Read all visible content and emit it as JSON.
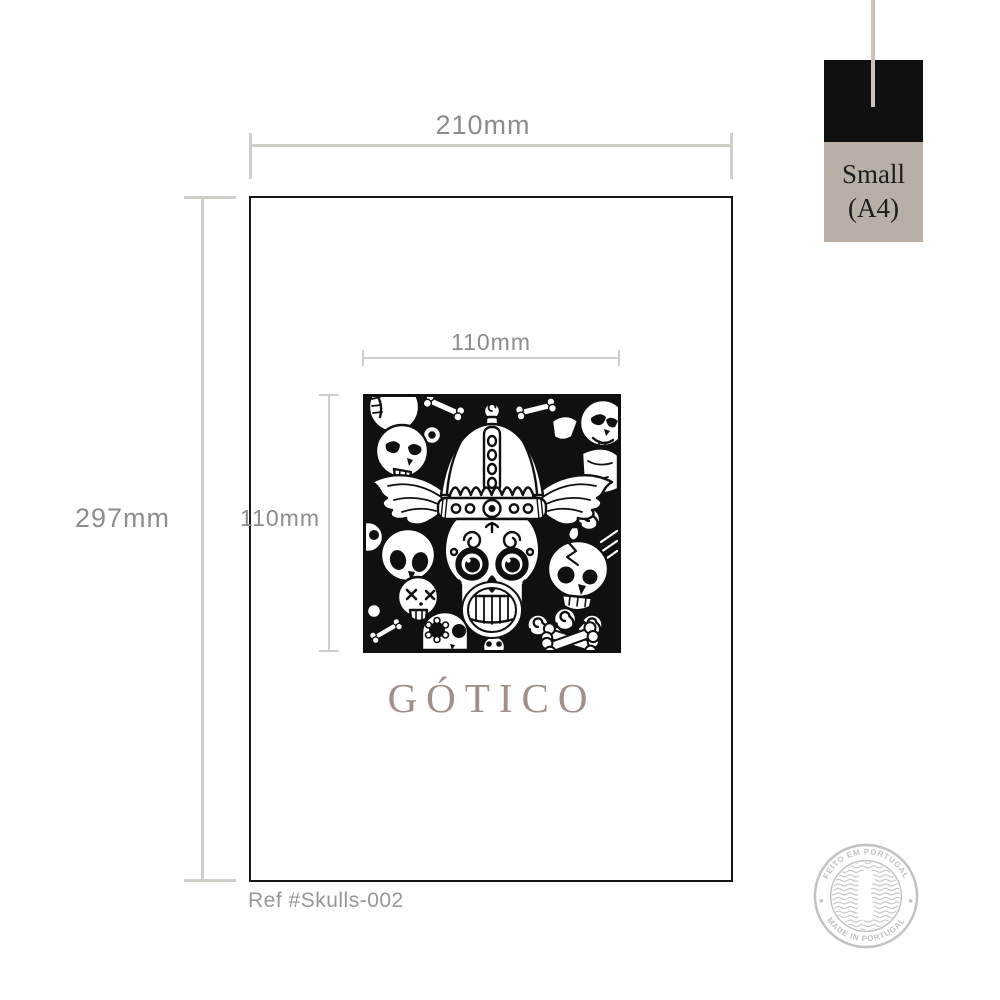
{
  "dims": {
    "paper_width": "210mm",
    "paper_height": "297mm",
    "artwork_width": "110mm",
    "artwork_height": "110mm"
  },
  "artwork": {
    "title": "GÓTICO"
  },
  "ref": {
    "label": "Ref #Skulls-002"
  },
  "badge": {
    "size": "Small",
    "format": "(A4)"
  },
  "stamp": {
    "arc_top": "FEITO EM PORTUGAL",
    "arc_bottom": "MADE IN PORTUGAL"
  },
  "colors": {
    "dim_line": "#cfcec9",
    "dim_text": "#8c8c8c",
    "paper_border": "#161616",
    "artwork_ink": "#101010",
    "title_text": "#a18f89",
    "ref_text": "#979797",
    "badge_swatch": "#101010",
    "badge_bg": "#b8b0a6",
    "badge_text": "#1d1d1d",
    "thread": "#cac4ba",
    "stamp_gray": "#c3c3c5"
  }
}
